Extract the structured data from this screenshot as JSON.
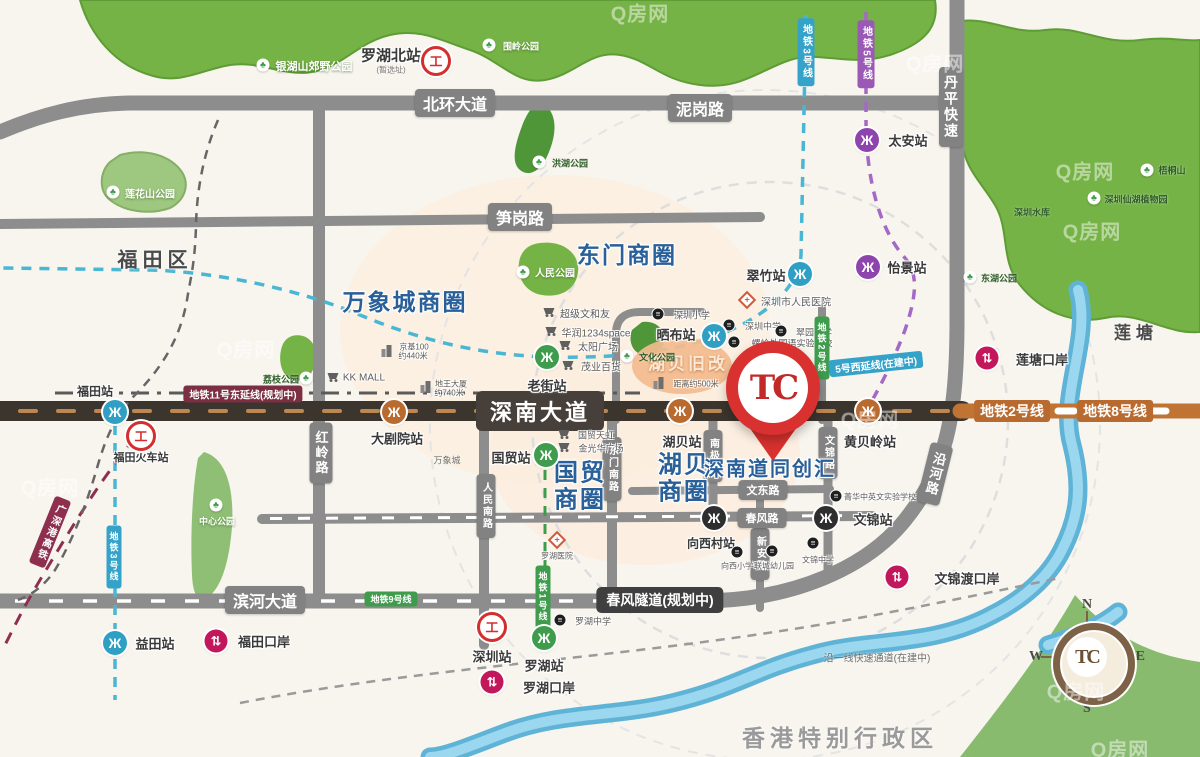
{
  "project": {
    "name": "深南道同创汇",
    "pin_logo": "TC"
  },
  "compass": {
    "n": "N",
    "e": "E",
    "s": "S",
    "w": "W",
    "logo": "TC"
  },
  "colors": {
    "accent_red": "#d8312f",
    "metro_blue": "#2f9fc4",
    "metro_green": "#3f9c4d",
    "metro_orange": "#b96a2e",
    "metro_purple": "#8e44ad",
    "metro_black": "#2e2e2e",
    "port_crimson": "#c2185b",
    "biz_blue": "#2a6099",
    "road_gray": "#8d8d8d",
    "road_dark": "#3b352e",
    "park_green": "#76b346",
    "river_blue": "#5fb3d6"
  },
  "map": {
    "items": [
      {
        "k": "pill",
        "t": "北环大道",
        "x": 455,
        "y": 103,
        "fs": 16,
        "n": "road-label-beihuan-avenue"
      },
      {
        "k": "pill",
        "t": "泥岗路",
        "x": 700,
        "y": 108,
        "fs": 16,
        "n": "road-label-nigang-road"
      },
      {
        "k": "pill",
        "t": "笋岗路",
        "x": 520,
        "y": 217,
        "fs": 16,
        "n": "road-label-sungang-road"
      },
      {
        "k": "pill-dark",
        "t": "深南大道",
        "x": 540,
        "y": 411,
        "fs": 22,
        "n": "road-label-shennan-avenue"
      },
      {
        "k": "pill",
        "t": "滨河大道",
        "x": 265,
        "y": 600,
        "fs": 16,
        "n": "road-label-binhe-avenue"
      },
      {
        "k": "pill-tunnel",
        "t": "春风隧道(规划中)",
        "x": 660,
        "y": 600,
        "fs": 14,
        "n": "road-label-chunfeng-tunnel"
      },
      {
        "k": "pill",
        "t": "丹平快速",
        "x": 951,
        "y": 107,
        "v": 1,
        "fs": 14,
        "n": "road-label-danping-expressway"
      },
      {
        "k": "pill",
        "t": "红岭路",
        "x": 321,
        "y": 453,
        "v": 1,
        "fs": 13,
        "n": "road-label-hongling-road"
      },
      {
        "k": "pill",
        "t": "沿河路",
        "x": 935,
        "y": 474,
        "v": 1,
        "fs": 13,
        "r": 14,
        "n": "road-label-yanhe-road"
      },
      {
        "k": "pill",
        "t": "东门南路",
        "x": 612,
        "y": 469,
        "v": 1,
        "fs": 10,
        "n": "road-label-dongmen-south"
      },
      {
        "k": "pill",
        "t": "人民南路",
        "x": 486,
        "y": 506,
        "v": 1,
        "fs": 10,
        "n": "road-label-renmin-south"
      },
      {
        "k": "pill",
        "t": "南极路",
        "x": 713,
        "y": 456,
        "v": 1,
        "fs": 10,
        "n": "road-label-nanji-road"
      },
      {
        "k": "pill",
        "t": "文锦路",
        "x": 828,
        "y": 453,
        "v": 1,
        "fs": 10,
        "n": "road-label-wenjin-road"
      },
      {
        "k": "pill",
        "t": "新安路",
        "x": 760,
        "y": 554,
        "v": 1,
        "fs": 10,
        "n": "road-label-xinan-road"
      },
      {
        "k": "pill",
        "t": "文东路",
        "x": 763,
        "y": 490,
        "fs": 11,
        "n": "road-label-wendong-road"
      },
      {
        "k": "pill",
        "t": "春风路",
        "x": 762,
        "y": 518,
        "fs": 11,
        "n": "road-label-chunfeng-road"
      },
      {
        "k": "mtag",
        "t": "地铁11号东延线(规划中)",
        "x": 243,
        "y": 394,
        "c": "#7c2f42",
        "fs": 10
      },
      {
        "k": "mtag",
        "t": "地铁2号线",
        "x": 1012,
        "y": 411,
        "c": "#b96a2e",
        "fs": 14
      },
      {
        "k": "mtag",
        "t": "地铁8号线",
        "x": 1115,
        "y": 411,
        "c": "#b96a2e",
        "fs": 14
      },
      {
        "k": "mtag",
        "t": "地铁9号线",
        "x": 391,
        "y": 599,
        "c": "#3f9c4d",
        "fs": 9
      },
      {
        "k": "mtag",
        "t": "地铁1号线",
        "x": 543,
        "y": 597,
        "c": "#3f9c4d",
        "fs": 9,
        "v": 1
      },
      {
        "k": "mtag",
        "t": "地铁2号线",
        "x": 822,
        "y": 348,
        "c": "#3f9c4d",
        "fs": 9,
        "v": 1
      },
      {
        "k": "mtag",
        "t": "5号西延线(在建中)",
        "x": 876,
        "y": 364,
        "c": "#35a3c9",
        "fs": 10,
        "r": -6
      },
      {
        "k": "mtag",
        "t": "地铁3号线",
        "x": 806,
        "y": 52,
        "c": "#35a3c9",
        "fs": 10,
        "v": 1
      },
      {
        "k": "mtag",
        "t": "地铁5号线",
        "x": 866,
        "y": 54,
        "c": "#9b59b6",
        "fs": 10,
        "v": 1
      },
      {
        "k": "mtag",
        "t": "地铁3号线",
        "x": 114,
        "y": 557,
        "c": "#35a3c9",
        "fs": 9,
        "v": 1
      },
      {
        "k": "mtag",
        "t": "广深港高铁",
        "x": 50,
        "y": 532,
        "c": "#8e2f4f",
        "fs": 10,
        "v": 1,
        "r": 22
      },
      {
        "k": "biz",
        "t": "万象城商圈",
        "x": 405,
        "y": 300,
        "fs": 23
      },
      {
        "k": "biz",
        "t": "东门商圈",
        "x": 627,
        "y": 253,
        "fs": 23
      },
      {
        "k": "biz",
        "t": "国贸",
        "x": 580,
        "y": 470,
        "fs": 24
      },
      {
        "k": "biz",
        "t": "商圈",
        "x": 580,
        "y": 497,
        "fs": 24
      },
      {
        "k": "biz",
        "t": "湖贝",
        "x": 684,
        "y": 462,
        "fs": 24
      },
      {
        "k": "biz",
        "t": "商圈",
        "x": 684,
        "y": 489,
        "fs": 24
      },
      {
        "k": "biz",
        "t": "深南道同创汇",
        "x": 770,
        "y": 467,
        "fs": 20,
        "n": "project-name-label"
      },
      {
        "k": "icon-metro",
        "x": 115,
        "y": 412,
        "c": "#2f9fc4",
        "n": "metro-icon-futian"
      },
      {
        "k": "icon-metro",
        "x": 115,
        "y": 643,
        "c": "#2f9fc4",
        "n": "metro-icon-yitian"
      },
      {
        "k": "icon-metro",
        "x": 800,
        "y": 274,
        "c": "#2f9fc4",
        "n": "metro-icon-cuizhu"
      },
      {
        "k": "icon-metro",
        "x": 714,
        "y": 336,
        "c": "#2f9fc4",
        "n": "metro-icon-shaibu"
      },
      {
        "k": "icon-metro",
        "x": 867,
        "y": 140,
        "c": "#8e44ad",
        "n": "metro-icon-taian"
      },
      {
        "k": "icon-metro",
        "x": 868,
        "y": 267,
        "c": "#8e44ad",
        "n": "metro-icon-yijing"
      },
      {
        "k": "icon-metro",
        "x": 547,
        "y": 357,
        "c": "#3f9c4d",
        "n": "metro-icon-laojie"
      },
      {
        "k": "icon-metro",
        "x": 546,
        "y": 455,
        "c": "#3f9c4d",
        "n": "metro-icon-guomao"
      },
      {
        "k": "icon-metro",
        "x": 544,
        "y": 638,
        "c": "#3f9c4d",
        "n": "metro-icon-luohu"
      },
      {
        "k": "icon-metro",
        "x": 394,
        "y": 412,
        "c": "#b96a2e",
        "n": "metro-icon-dajuyuan"
      },
      {
        "k": "icon-metro",
        "x": 680,
        "y": 411,
        "c": "#b96a2e",
        "n": "metro-icon-hubei"
      },
      {
        "k": "icon-metro",
        "x": 868,
        "y": 411,
        "c": "#b96a2e",
        "n": "metro-icon-huangbeiling"
      },
      {
        "k": "icon-metro",
        "x": 714,
        "y": 518,
        "c": "#2e2e2e",
        "n": "metro-icon-xiangxicun"
      },
      {
        "k": "icon-metro",
        "x": 826,
        "y": 518,
        "c": "#2e2e2e",
        "n": "metro-icon-wenjin"
      },
      {
        "k": "icon-rail",
        "x": 436,
        "y": 61,
        "n": "railway-icon-luohu-north"
      },
      {
        "k": "icon-rail",
        "x": 141,
        "y": 436,
        "n": "railway-icon-futian"
      },
      {
        "k": "icon-rail",
        "x": 492,
        "y": 627,
        "n": "railway-icon-shenzhen"
      },
      {
        "k": "icon-port",
        "x": 987,
        "y": 358,
        "n": "port-icon-liantang"
      },
      {
        "k": "icon-port",
        "x": 897,
        "y": 577,
        "n": "port-icon-wenjindu"
      },
      {
        "k": "icon-port",
        "x": 216,
        "y": 641,
        "n": "port-icon-futian"
      },
      {
        "k": "icon-port",
        "x": 492,
        "y": 682,
        "n": "port-icon-luohu"
      },
      {
        "k": "st",
        "t": "福田站",
        "x": 95,
        "y": 391,
        "fs": 12
      },
      {
        "k": "st",
        "t": "益田站",
        "x": 155,
        "y": 643,
        "fs": 13
      },
      {
        "k": "st",
        "t": "翠竹站",
        "x": 766,
        "y": 275,
        "fs": 13
      },
      {
        "k": "st",
        "t": "晒布站",
        "x": 676,
        "y": 334,
        "fs": 13
      },
      {
        "k": "st",
        "t": "太安站",
        "x": 908,
        "y": 140,
        "fs": 13
      },
      {
        "k": "st",
        "t": "怡景站",
        "x": 907,
        "y": 267,
        "fs": 13
      },
      {
        "k": "st",
        "t": "老街站",
        "x": 547,
        "y": 385,
        "fs": 13
      },
      {
        "k": "st",
        "t": "国贸站",
        "x": 511,
        "y": 457,
        "fs": 13
      },
      {
        "k": "st",
        "t": "罗湖站",
        "x": 544,
        "y": 665,
        "fs": 13
      },
      {
        "k": "st",
        "t": "大剧院站",
        "x": 397,
        "y": 438,
        "fs": 13
      },
      {
        "k": "st",
        "t": "湖贝站",
        "x": 682,
        "y": 441,
        "fs": 13
      },
      {
        "k": "st",
        "t": "黄贝岭站",
        "x": 870,
        "y": 441,
        "fs": 13
      },
      {
        "k": "st",
        "t": "向西村站",
        "x": 711,
        "y": 543,
        "fs": 12
      },
      {
        "k": "st",
        "t": "文锦站",
        "x": 873,
        "y": 519,
        "fs": 13
      },
      {
        "k": "st",
        "t": "罗湖北站",
        "x": 391,
        "y": 55,
        "fs": 15
      },
      {
        "k": "sub",
        "t": "(暂选址)",
        "x": 391,
        "y": 70,
        "fs": 8
      },
      {
        "k": "st",
        "t": "福田火车站",
        "x": 141,
        "y": 457,
        "fs": 11
      },
      {
        "k": "st",
        "t": "深圳站",
        "x": 492,
        "y": 656,
        "fs": 13
      },
      {
        "k": "st",
        "t": "莲塘口岸",
        "x": 1042,
        "y": 359,
        "fs": 13
      },
      {
        "k": "st",
        "t": "文锦渡口岸",
        "x": 967,
        "y": 578,
        "fs": 13
      },
      {
        "k": "st",
        "t": "福田口岸",
        "x": 264,
        "y": 641,
        "fs": 13
      },
      {
        "k": "st",
        "t": "罗湖口岸",
        "x": 549,
        "y": 687,
        "fs": 13
      },
      {
        "k": "icon-school",
        "x": 658,
        "y": 314
      },
      {
        "k": "poi",
        "t": "深圳小学",
        "x": 692,
        "y": 315,
        "fs": 9
      },
      {
        "k": "icon-school",
        "x": 729,
        "y": 325
      },
      {
        "k": "poi",
        "t": "深圳中学",
        "x": 763,
        "y": 326,
        "fs": 9
      },
      {
        "k": "icon-school",
        "x": 781,
        "y": 331
      },
      {
        "k": "poi",
        "t": "翠园中学",
        "x": 814,
        "y": 332,
        "fs": 9
      },
      {
        "k": "icon-school",
        "x": 734,
        "y": 342
      },
      {
        "k": "poi",
        "t": "螺岭外国语实验学校",
        "x": 792,
        "y": 343,
        "fs": 9
      },
      {
        "k": "icon-school",
        "x": 836,
        "y": 496
      },
      {
        "k": "poi",
        "t": "菁华中英文实验学校",
        "x": 880,
        "y": 497,
        "fs": 8
      },
      {
        "k": "icon-school",
        "x": 737,
        "y": 552
      },
      {
        "k": "poi",
        "t": "向西小学",
        "x": 737,
        "y": 566,
        "fs": 8
      },
      {
        "k": "icon-school",
        "x": 772,
        "y": 551
      },
      {
        "k": "poi",
        "t": "联城幼儿园",
        "x": 774,
        "y": 566,
        "fs": 8
      },
      {
        "k": "icon-school",
        "x": 813,
        "y": 543
      },
      {
        "k": "poi",
        "t": "文锦中学",
        "x": 818,
        "y": 560,
        "fs": 8
      },
      {
        "k": "icon-school",
        "x": 560,
        "y": 620
      },
      {
        "k": "poi",
        "t": "罗湖中学",
        "x": 593,
        "y": 621,
        "fs": 9
      },
      {
        "k": "icon-hosp",
        "x": 747,
        "y": 300,
        "r": 45
      },
      {
        "k": "poi",
        "t": "深圳市人民医院",
        "x": 796,
        "y": 301,
        "fs": 10
      },
      {
        "k": "icon-hosp",
        "x": 557,
        "y": 540,
        "r": 45
      },
      {
        "k": "poi",
        "t": "罗湖医院",
        "x": 557,
        "y": 556,
        "fs": 8
      },
      {
        "k": "icon-cart",
        "x": 333,
        "y": 377
      },
      {
        "k": "poi",
        "t": "KK MALL",
        "x": 364,
        "y": 378,
        "fs": 10
      },
      {
        "k": "icon-cart",
        "x": 549,
        "y": 312
      },
      {
        "k": "poi",
        "t": "超级文和友",
        "x": 585,
        "y": 313,
        "fs": 10
      },
      {
        "k": "icon-cart",
        "x": 551,
        "y": 331
      },
      {
        "k": "poi",
        "t": "华润1234space",
        "x": 596,
        "y": 332,
        "fs": 10
      },
      {
        "k": "icon-cart",
        "x": 565,
        "y": 345
      },
      {
        "k": "poi",
        "t": "太阳广场",
        "x": 598,
        "y": 346,
        "fs": 10
      },
      {
        "k": "icon-cart",
        "x": 568,
        "y": 365
      },
      {
        "k": "poi",
        "t": "茂业百货",
        "x": 601,
        "y": 366,
        "fs": 10
      },
      {
        "k": "icon-cart",
        "x": 564,
        "y": 434
      },
      {
        "k": "poi",
        "t": "国贸天虹",
        "x": 596,
        "y": 435,
        "fs": 9
      },
      {
        "k": "icon-cart",
        "x": 564,
        "y": 447
      },
      {
        "k": "poi",
        "t": "金光华广场",
        "x": 601,
        "y": 448,
        "fs": 9
      },
      {
        "k": "icon-bldg",
        "x": 387,
        "y": 351
      },
      {
        "k": "poi",
        "t": "京基100",
        "x": 414,
        "y": 347,
        "fs": 8
      },
      {
        "k": "poi",
        "t": "约440米",
        "x": 413,
        "y": 356,
        "fs": 8
      },
      {
        "k": "icon-bldg",
        "x": 426,
        "y": 387
      },
      {
        "k": "poi",
        "t": "地王大厦",
        "x": 451,
        "y": 384,
        "fs": 8
      },
      {
        "k": "poi",
        "t": "约740米",
        "x": 449,
        "y": 393,
        "fs": 8
      },
      {
        "k": "note",
        "t": "湖贝旧改",
        "x": 688,
        "y": 362,
        "fs": 17
      },
      {
        "k": "icon-bldg",
        "x": 659,
        "y": 383
      },
      {
        "k": "poi",
        "t": "距离约500米",
        "x": 696,
        "y": 384,
        "fs": 8
      },
      {
        "k": "gray",
        "t": "万象城",
        "x": 447,
        "y": 460,
        "fs": 9
      },
      {
        "k": "icon-tree",
        "x": 263,
        "y": 65
      },
      {
        "k": "park",
        "t": "银湖山郊野公园",
        "x": 314,
        "y": 66,
        "fs": 11
      },
      {
        "k": "icon-tree",
        "x": 489,
        "y": 45
      },
      {
        "k": "park",
        "t": "围岭公园",
        "x": 521,
        "y": 46,
        "fs": 9
      },
      {
        "k": "icon-tree",
        "x": 523,
        "y": 272
      },
      {
        "k": "park",
        "t": "人民公园",
        "x": 555,
        "y": 272,
        "fs": 10
      },
      {
        "k": "icon-tree",
        "x": 113,
        "y": 192
      },
      {
        "k": "park",
        "t": "莲花山公园",
        "x": 150,
        "y": 193,
        "fs": 10
      },
      {
        "k": "icon-tree",
        "x": 216,
        "y": 505
      },
      {
        "k": "park",
        "t": "中心公园",
        "x": 217,
        "y": 521,
        "fs": 9
      },
      {
        "k": "icon-tree",
        "x": 539,
        "y": 162
      },
      {
        "k": "parkd",
        "t": "洪湖公园",
        "x": 570,
        "y": 163,
        "fs": 9
      },
      {
        "k": "icon-tree",
        "x": 306,
        "y": 378
      },
      {
        "k": "parkd",
        "t": "荔枝公园",
        "x": 281,
        "y": 379,
        "fs": 9
      },
      {
        "k": "icon-tree",
        "x": 627,
        "y": 356
      },
      {
        "k": "parkd",
        "t": "文化公园",
        "x": 657,
        "y": 357,
        "fs": 9
      },
      {
        "k": "icon-tree",
        "x": 970,
        "y": 277
      },
      {
        "k": "parkd",
        "t": "东湖公园",
        "x": 999,
        "y": 278,
        "fs": 9
      },
      {
        "k": "icon-tree",
        "x": 1094,
        "y": 198
      },
      {
        "k": "parkd",
        "t": "深圳仙湖植物园",
        "x": 1136,
        "y": 199,
        "fs": 9
      },
      {
        "k": "icon-tree",
        "x": 1147,
        "y": 170
      },
      {
        "k": "parkd",
        "t": "梧桐山",
        "x": 1172,
        "y": 170,
        "fs": 9
      },
      {
        "k": "parkd",
        "t": "深圳水库",
        "x": 1032,
        "y": 212,
        "fs": 9
      },
      {
        "k": "region",
        "t": "福田区",
        "x": 155,
        "y": 258,
        "fs": 20
      },
      {
        "k": "region",
        "t": "莲塘",
        "x": 1136,
        "y": 331,
        "fs": 17
      },
      {
        "k": "region",
        "t": "香港特别行政区",
        "x": 840,
        "y": 736,
        "fs": 23,
        "c": "#9a9a9a"
      },
      {
        "k": "gray",
        "t": "沿一线快速通道(在建中)",
        "x": 877,
        "y": 657,
        "fs": 10
      },
      {
        "k": "wm",
        "t": "Q房网",
        "x": 640,
        "y": 12
      },
      {
        "k": "wm",
        "t": "Q房网",
        "x": 935,
        "y": 62
      },
      {
        "k": "wm",
        "t": "Q房网",
        "x": 1085,
        "y": 170
      },
      {
        "k": "wm",
        "t": "Q房网",
        "x": 1092,
        "y": 230
      },
      {
        "k": "wm",
        "t": "Q房网",
        "x": 870,
        "y": 418
      },
      {
        "k": "wm",
        "t": "Q房网",
        "x": 50,
        "y": 486
      },
      {
        "k": "wm",
        "t": "Q房网",
        "x": 246,
        "y": 348
      },
      {
        "k": "wm",
        "t": "Q房网",
        "x": 1076,
        "y": 690
      },
      {
        "k": "wm",
        "t": "Q房网",
        "x": 1120,
        "y": 748
      }
    ]
  }
}
